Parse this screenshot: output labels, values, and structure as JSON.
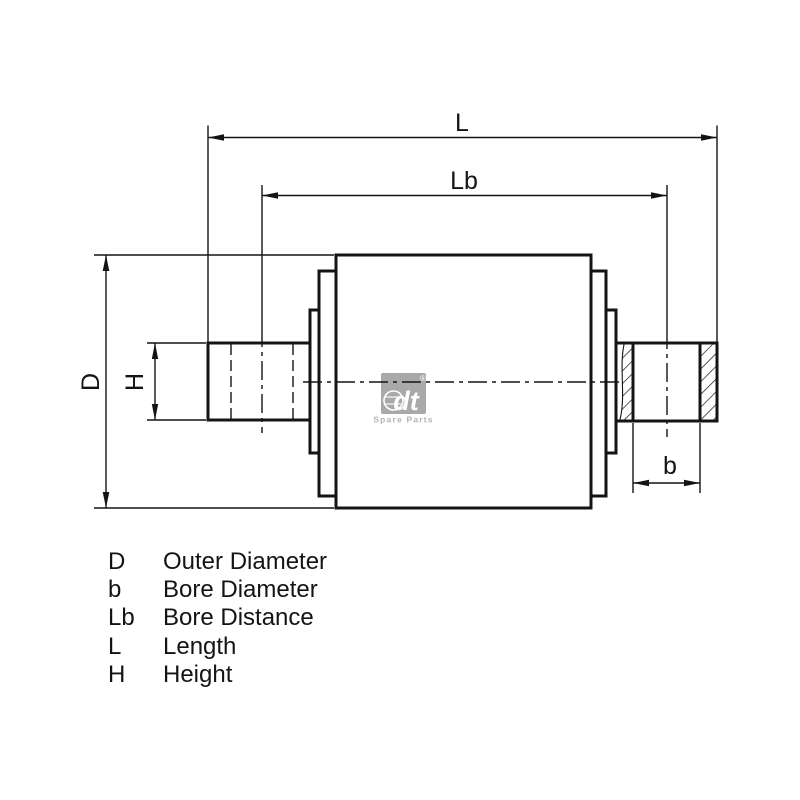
{
  "drawing": {
    "dim_labels": {
      "L": "L",
      "Lb": "Lb",
      "D": "D",
      "H": "H",
      "b": "b"
    }
  },
  "logo": {
    "brand": "dt",
    "registered": "®",
    "caption": "Spare Parts",
    "box_color": "#a9a9a9",
    "glyph_color": "#ffffff",
    "caption_color": "#b3b3b3"
  },
  "legend": {
    "rows": [
      {
        "symbol": "D",
        "description": "Outer Diameter"
      },
      {
        "symbol": "b",
        "description": "Bore Diameter"
      },
      {
        "symbol": "Lb",
        "description": "Bore Distance"
      },
      {
        "symbol": "L",
        "description": "Length"
      },
      {
        "symbol": "H",
        "description": "Height"
      }
    ]
  },
  "colors": {
    "line": "#141414",
    "background": "#ffffff"
  }
}
